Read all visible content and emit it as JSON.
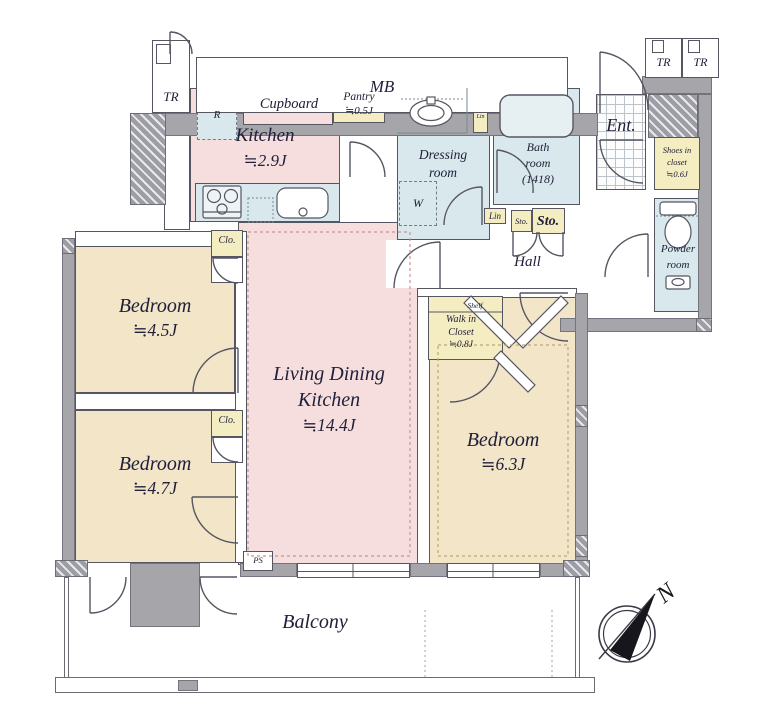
{
  "palette": {
    "room_pink": "#f7dede",
    "room_tan": "#f3e5c8",
    "wet_blue": "#d8e8ec",
    "closet_yellow": "#f5edc2",
    "wall_gray": "#a5a5aa",
    "line": "#565663",
    "text": "#20203a"
  },
  "plan": {
    "mb": "MB",
    "tr_top_left": "TR",
    "tr_top_right_1": "TR",
    "tr_top_right_2": "TR",
    "kitchen": {
      "name": "Kitchen",
      "size": "≒2.9J"
    },
    "cupboard": "Cupboard",
    "pantry": {
      "name": "Pantry",
      "size": "≒0.5J"
    },
    "refrigerator": "R",
    "dressing_room": {
      "line1": "Dressing",
      "line2": "room"
    },
    "bath_room": {
      "line1": "Bath",
      "line2": "room",
      "line3": "(1418)"
    },
    "entrance": "Ent.",
    "shoes_closet": {
      "line1": "Shoes in",
      "line2": "closet",
      "line3": "≒0.6J"
    },
    "powder_room": {
      "line1": "Powder",
      "line2": "room"
    },
    "washing_machine": "W",
    "linen_tall": "Lin",
    "linen_hall": "Lin",
    "storage_small": "Sto.",
    "storage_large": "Sto.",
    "hall": "Hall",
    "walk_in_closet": {
      "shelf": "Shelf",
      "line1": "Walk in",
      "line2": "Closet",
      "size": "≒0.8J"
    },
    "ldk": {
      "line1": "Living Dining",
      "line2": "Kitchen",
      "size": "≒14.4J"
    },
    "bedroom_45": {
      "name": "Bedroom",
      "size": "≒4.5J"
    },
    "bedroom_47": {
      "name": "Bedroom",
      "size": "≒4.7J"
    },
    "bedroom_63": {
      "name": "Bedroom",
      "size": "≒6.3J"
    },
    "closet_1": "Clo.",
    "closet_2": "Clo.",
    "pipe_space": "PS",
    "balcony": "Balcony",
    "compass_north": "N"
  }
}
